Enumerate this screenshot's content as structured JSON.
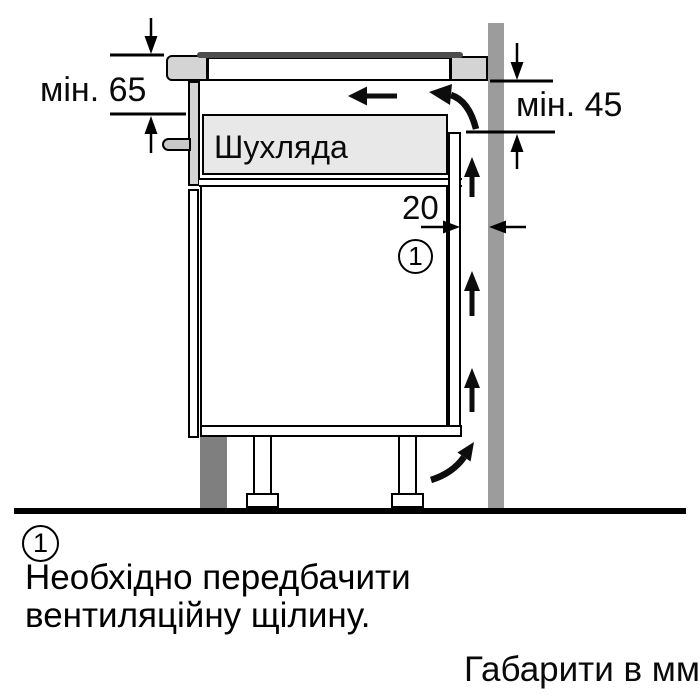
{
  "diagram": {
    "drawer_label": "Шухляда",
    "dim_top_clearance": "мін. 65",
    "dim_side_clearance": "мін. 45",
    "dim_vent_gap": "20",
    "callout_number": "1"
  },
  "footnote": {
    "number": "1",
    "line1": "Необхідно передбачити",
    "line2": "вентиляційну щілину."
  },
  "units_note": "Габарити в мм",
  "colors": {
    "outline": "#000000",
    "wall_gray": "#9c9c9c",
    "worktop_gray": "#d4d4d4",
    "drawer_gray": "#e8e8e8",
    "plinth_dark_gray": "#7f7f7f",
    "hob_glass_dark": "#4d4d4d",
    "background": "#ffffff"
  }
}
